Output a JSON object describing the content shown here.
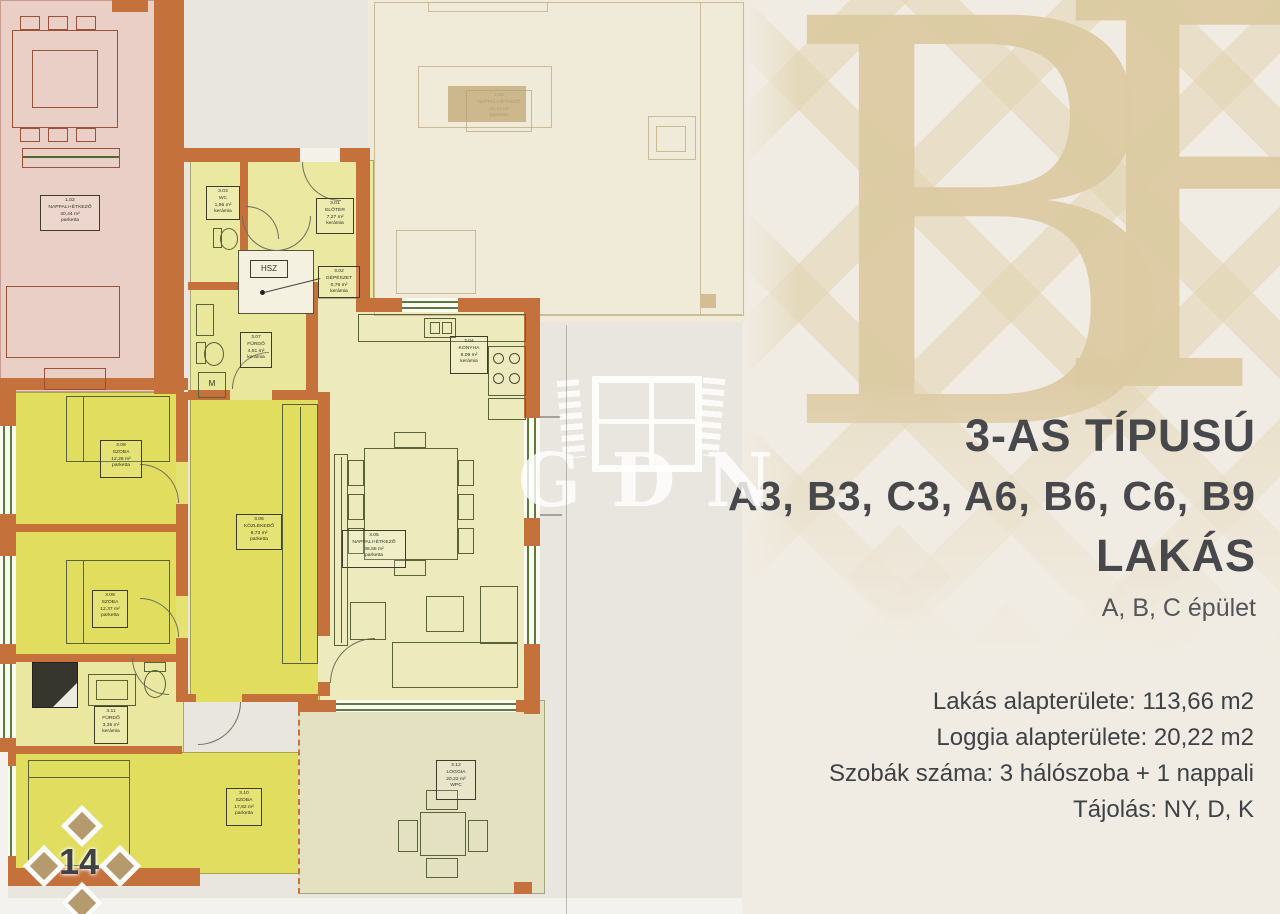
{
  "page": {
    "number": "14",
    "monogram_letters": [
      "B",
      "F"
    ],
    "watermark": "GDN"
  },
  "info_panel": {
    "title": "3-AS TÍPUSÚ",
    "units_line": "A3, B3, C3, A6, B6, C6, B9",
    "type_word": "LAKÁS",
    "buildings": "A, B, C épület",
    "details": {
      "apartment_area": "Lakás alapterülete: 113,66 m2",
      "loggia_area": "Loggia alapterülete: 20,22 m2",
      "rooms_count": "Szobák száma: 3 hálószoba + 1 nappali",
      "orientation": "Tájolás: NY, D, K"
    }
  },
  "floor_plan": {
    "adjacent_unit_label": {
      "id": "1.02",
      "name": "NAPPALI+ÉTKEZŐ",
      "area": "40,44 m²",
      "floor": "parketta"
    },
    "faded_unit_label": {
      "id": "2.02",
      "name": "NAPPALI+ÉTKEZŐ",
      "area": "42,43 m²",
      "floor": "parketta"
    },
    "shaft_label": "HSZ",
    "washing_machine_label": "M",
    "rooms": [
      {
        "id": "3.01",
        "name": "ELŐTÉR",
        "area": "7,27 m²",
        "floor": "kerámia"
      },
      {
        "id": "3.02",
        "name": "GÉPÉSZET",
        "area": "0,76 m²",
        "floor": "kerámia"
      },
      {
        "id": "3.03",
        "name": "WC",
        "area": "1,95 m²",
        "floor": "kerámia"
      },
      {
        "id": "3.04",
        "name": "KONYHA",
        "area": "8,09 m²",
        "floor": "kerámia"
      },
      {
        "id": "3.05",
        "name": "NAPPALI+ÉTKEZŐ",
        "area": "36,55 m²",
        "floor": "parketta"
      },
      {
        "id": "3.06",
        "name": "KÖZLEKEDŐ",
        "area": "8,73 m²",
        "floor": "parketta"
      },
      {
        "id": "3.07",
        "name": "FÜRDŐ",
        "area": "4,51 m²",
        "floor": "kerámia"
      },
      {
        "id": "3.08",
        "name": "SZOBA",
        "area": "12,26 m²",
        "floor": "parketta"
      },
      {
        "id": "3.09",
        "name": "SZOBA",
        "area": "12,37 m²",
        "floor": "parketta"
      },
      {
        "id": "3.10",
        "name": "SZOBA",
        "area": "17,82 m²",
        "floor": "parketta"
      },
      {
        "id": "3.11",
        "name": "FÜRDŐ",
        "area": "3,35 m²",
        "floor": "kerámia"
      },
      {
        "id": "3.12",
        "name": "LOGGIA",
        "area": "20,22 m²",
        "floor": "WPC"
      }
    ]
  }
}
